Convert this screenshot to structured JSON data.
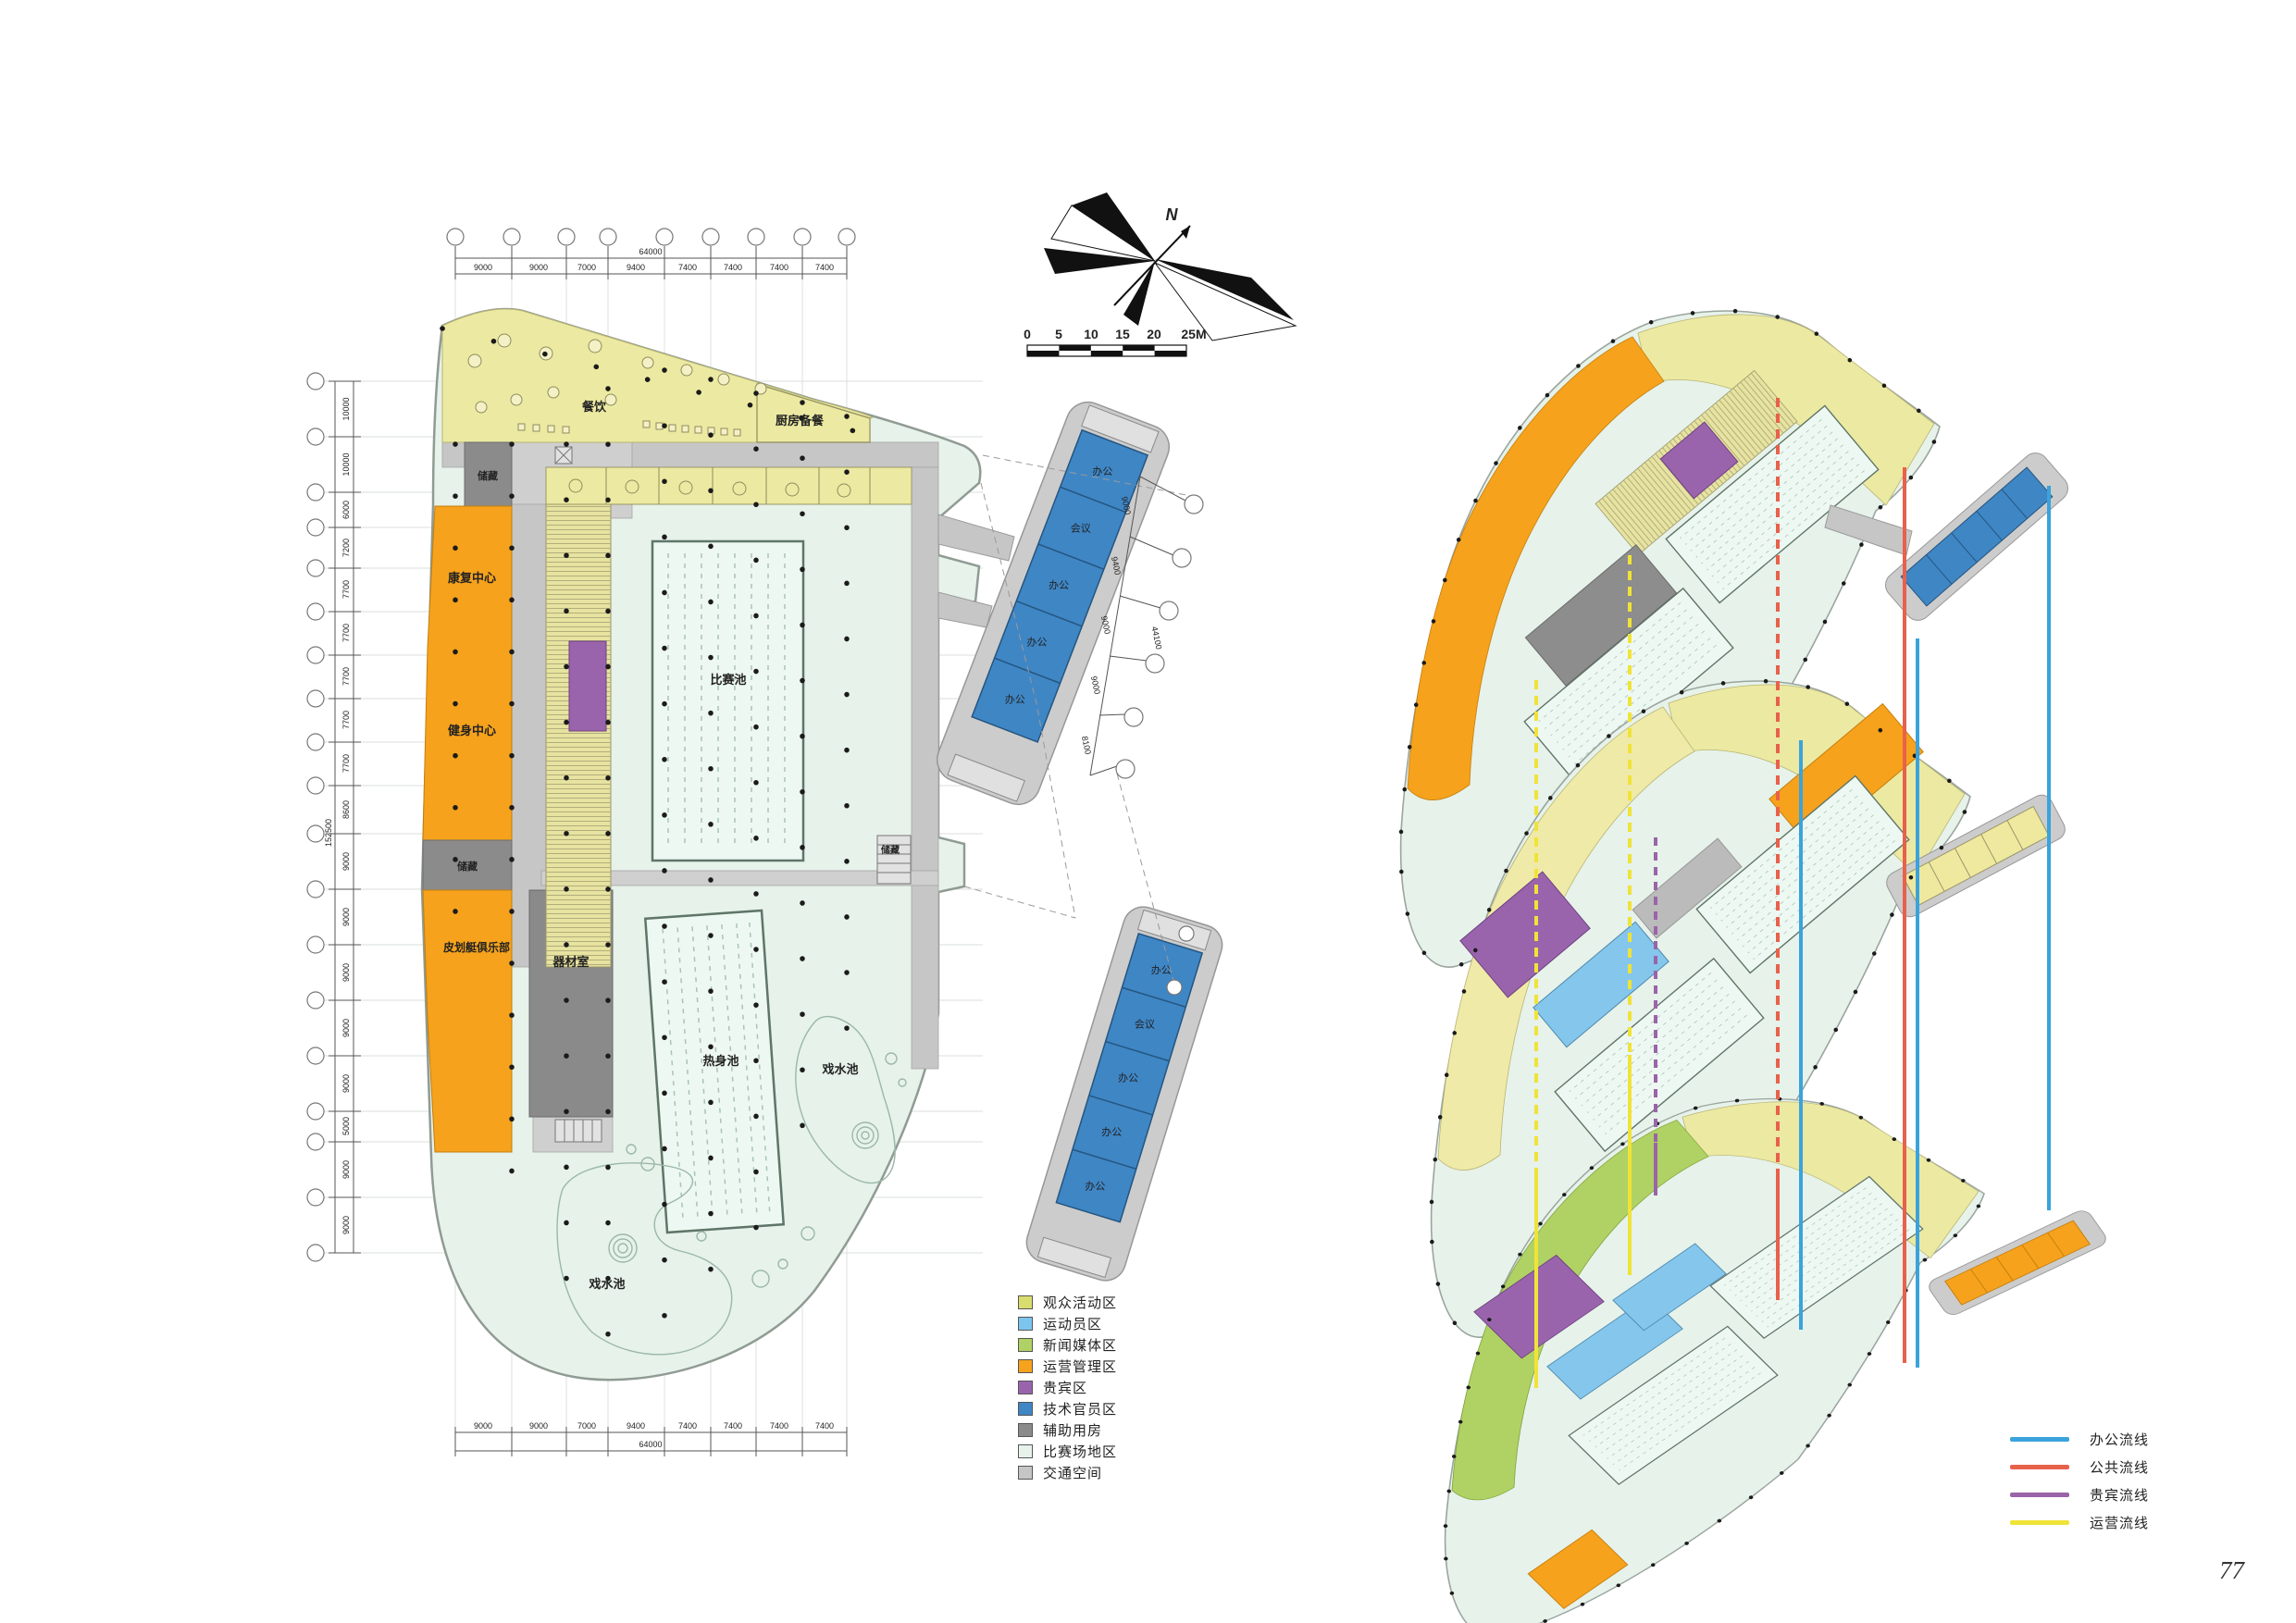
{
  "page": {
    "number": "77"
  },
  "plan": {
    "labels": {
      "dining": "餐饮",
      "kitchen": "厨房备餐",
      "storage_top": "储藏",
      "rehab": "康复中心",
      "fitness": "健身中心",
      "storage_mid": "储藏",
      "kayak": "皮划艇俱乐部",
      "equipment": "器材室",
      "competition_pool": "比赛池",
      "warmup_pool": "热身池",
      "play_pool_left": "戏水池",
      "play_pool_right": "戏水池",
      "storage_right": "储藏"
    },
    "annex_rooms": [
      "办公",
      "会议",
      "办公",
      "办公",
      "办公"
    ],
    "dims_h": [
      "9000",
      "9000",
      "7000",
      "9400",
      "7400",
      "7400",
      "7400",
      "7400"
    ],
    "dims_h_total": "64000",
    "dims_left": [
      "10000",
      "10000",
      "6000",
      "7200",
      "7700",
      "7700",
      "7700",
      "7700",
      "7700",
      "8600",
      "9000",
      "9000",
      "9000",
      "9000",
      "9000",
      "5000",
      "9000",
      "9000"
    ],
    "dims_left_total": "152500",
    "dims_annex": [
      "9000",
      "9400",
      "9000",
      "9000",
      "8100"
    ],
    "dims_annex_total": "44100"
  },
  "compass": {
    "label": "N"
  },
  "scalebar": {
    "labels": [
      "0",
      "5",
      "10",
      "15",
      "20",
      "25M"
    ]
  },
  "zone_legend": {
    "items": [
      {
        "label": "观众活动区",
        "color": "#d9dd6e"
      },
      {
        "label": "运动员区",
        "color": "#7cc5ee"
      },
      {
        "label": "新闻媒体区",
        "color": "#b0d264"
      },
      {
        "label": "运营管理区",
        "color": "#f6a21c"
      },
      {
        "label": "贵宾区",
        "color": "#9a64ad"
      },
      {
        "label": "技术官员区",
        "color": "#3f86c5"
      },
      {
        "label": "辅助用房",
        "color": "#8b8b8b"
      },
      {
        "label": "比赛场地区",
        "color": "#e6f2ea"
      },
      {
        "label": "交通空间",
        "color": "#c6c6c6"
      }
    ]
  },
  "line_legend": {
    "items": [
      {
        "label": "办公流线",
        "color": "#3aa3dc"
      },
      {
        "label": "公共流线",
        "color": "#e8614b"
      },
      {
        "label": "贵宾流线",
        "color": "#9a64a8"
      },
      {
        "label": "运营流线",
        "color": "#f0e338"
      }
    ]
  }
}
